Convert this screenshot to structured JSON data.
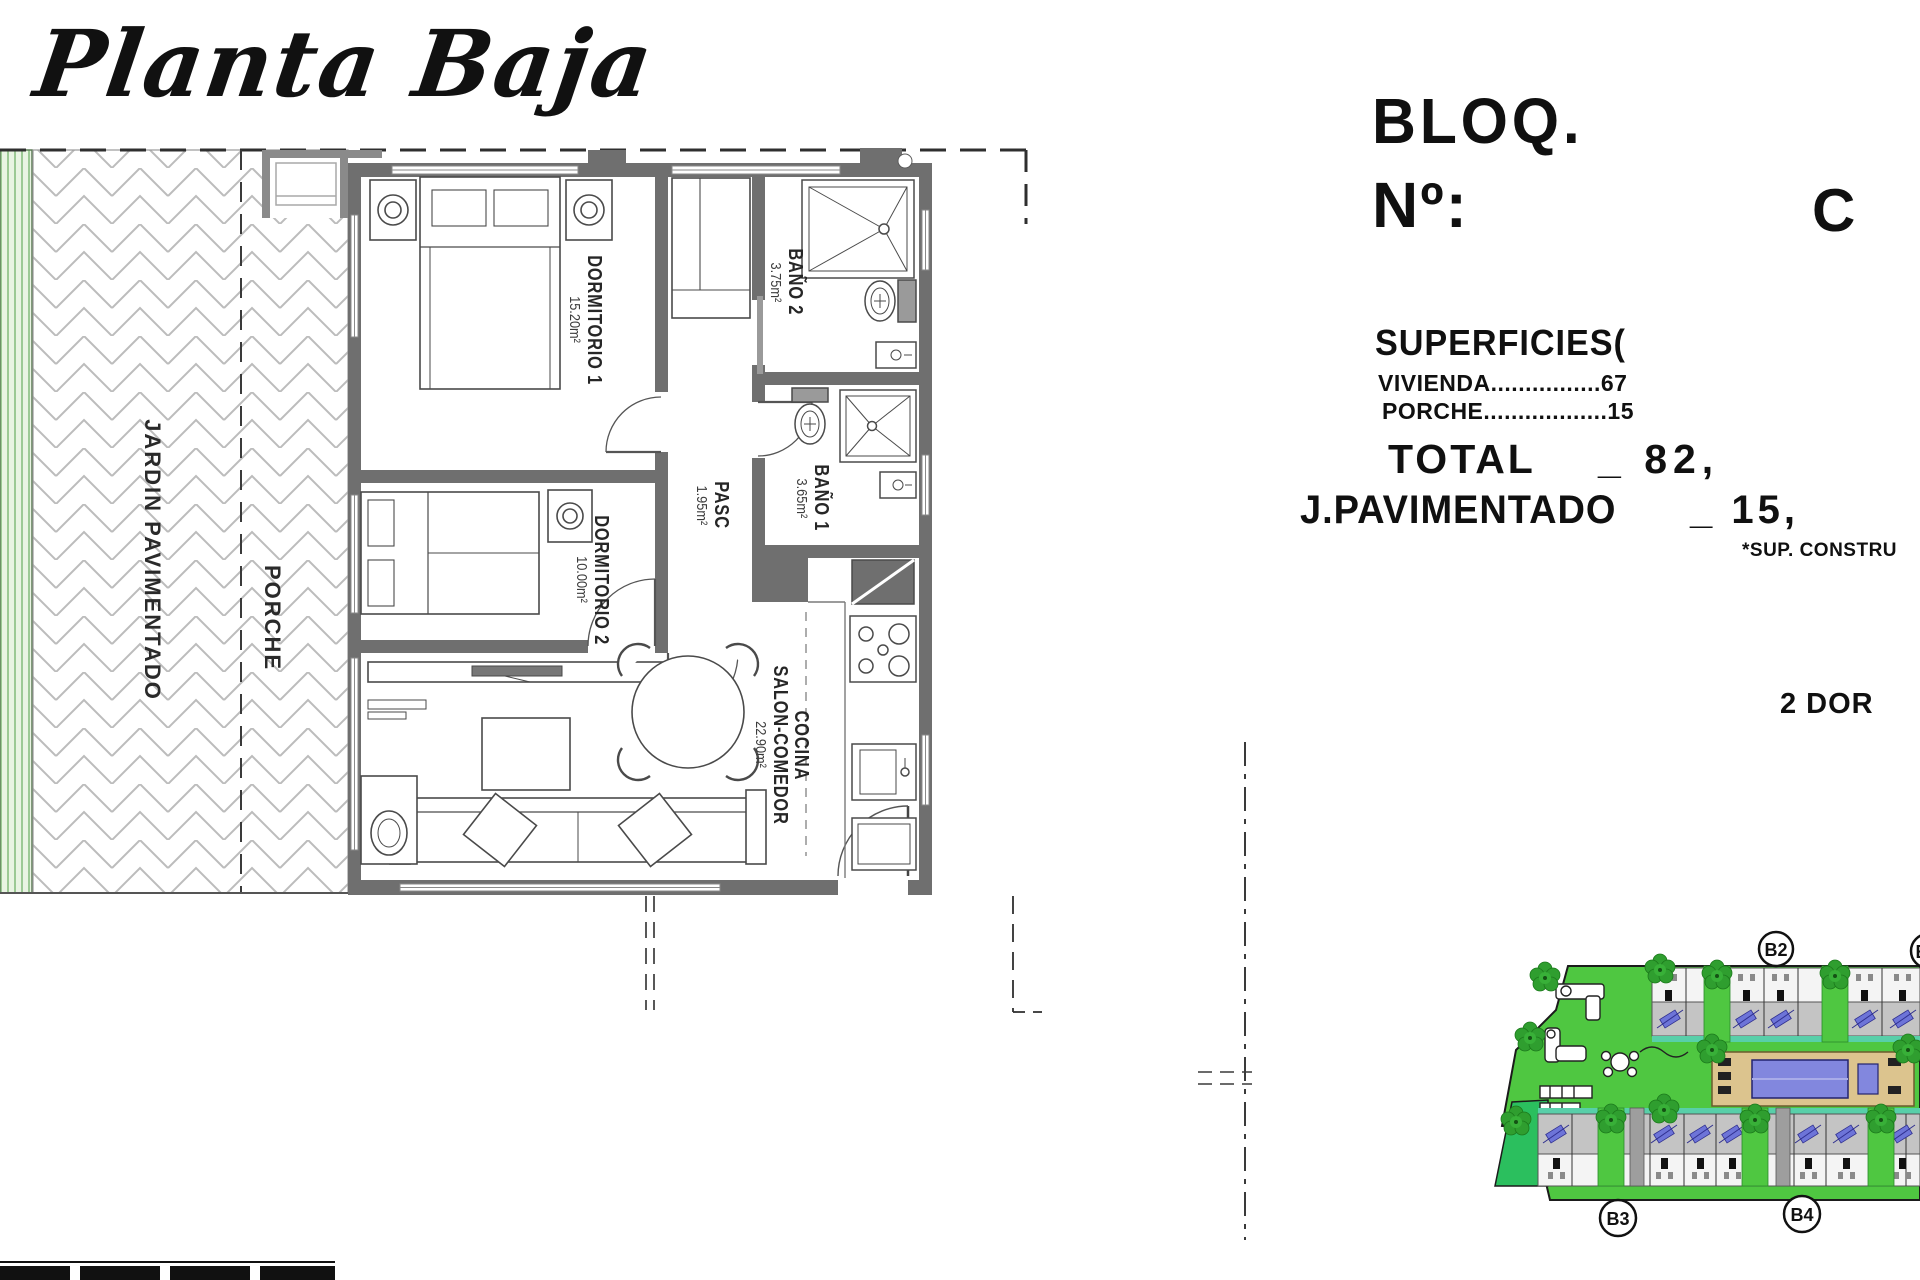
{
  "title": "Planta Baja",
  "info": {
    "bloq": "BLOQ.",
    "num": "Nº:",
    "num_value": "C",
    "superficies": "SUPERFICIES(",
    "vivienda": "VIVIENDA................67",
    "porche_line": "PORCHE..................15",
    "total_label": "TOTAL",
    "total_value": "_ 82,",
    "jpav_label": "J.PAVIMENTADO",
    "jpav_value": "_ 15,",
    "footnote": "*SUP. CONSTRU",
    "unit_type": "2 DOR"
  },
  "rooms": {
    "d1": {
      "name": "DORMITORIO 1",
      "area": "15.20m²"
    },
    "d2": {
      "name": "DORMITORIO 2",
      "area": "10.00m²"
    },
    "b2": {
      "name": "BAÑO 2",
      "area": "3.75m²"
    },
    "b1": {
      "name": "BAÑO 1",
      "area": "3.65m²"
    },
    "pasc": {
      "name": "PASC",
      "area": "1.95m²"
    },
    "salon": {
      "line1": "COCINA",
      "line2": "SALON-COMEDOR",
      "area": "22.90m²"
    }
  },
  "outdoor": {
    "jardin": "JARDIN PAVIMENTADO",
    "porche": "PORCHE"
  },
  "site": {
    "blocks": [
      "B2",
      "B",
      "B3",
      "B4"
    ]
  },
  "colors": {
    "wall_gray": "#6f6f6f",
    "hatch_gray": "#bcbcbc",
    "garden_strip_green": "#9cc995",
    "site_green": "#4fc741",
    "tree_green": "#2f9e2f",
    "pool_blue": "#8287de",
    "deck_tan": "#dcc48e",
    "terrace_gray": "#c4c4c4",
    "teal_strip": "#58cfa9",
    "unit_mark_blue": "#6d74d8"
  }
}
